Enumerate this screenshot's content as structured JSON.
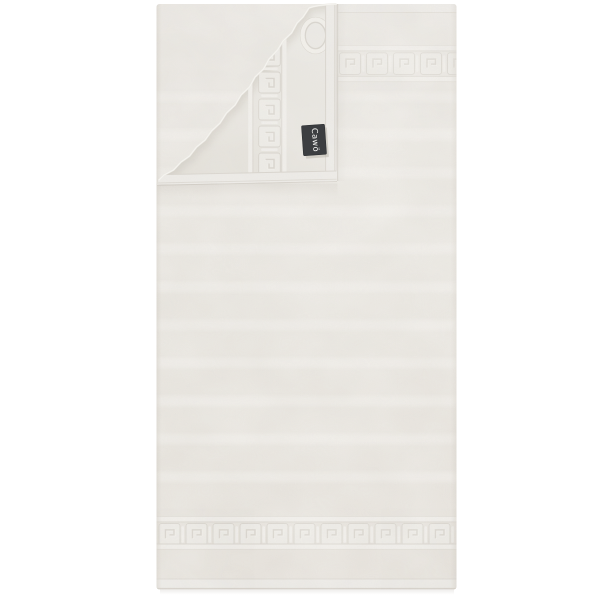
{
  "image": {
    "background_color": "#ffffff",
    "subject": "folded-towel-product-photo"
  },
  "product": {
    "brand_label": {
      "text": "Cawö",
      "background_color": "#3c3e41",
      "text_color": "#f6f6f4"
    },
    "towel": {
      "base_color": "#eae7e1",
      "highlight_color": "#f3f1ed",
      "groove_color": "#d8d4cd",
      "hem_color": "#efede9",
      "border_pattern": "greek-key",
      "body_pattern": "horizontal-stripes",
      "corner_detail": "folded-over-corner",
      "loop_detail": "embossed-hanging-loop"
    }
  }
}
